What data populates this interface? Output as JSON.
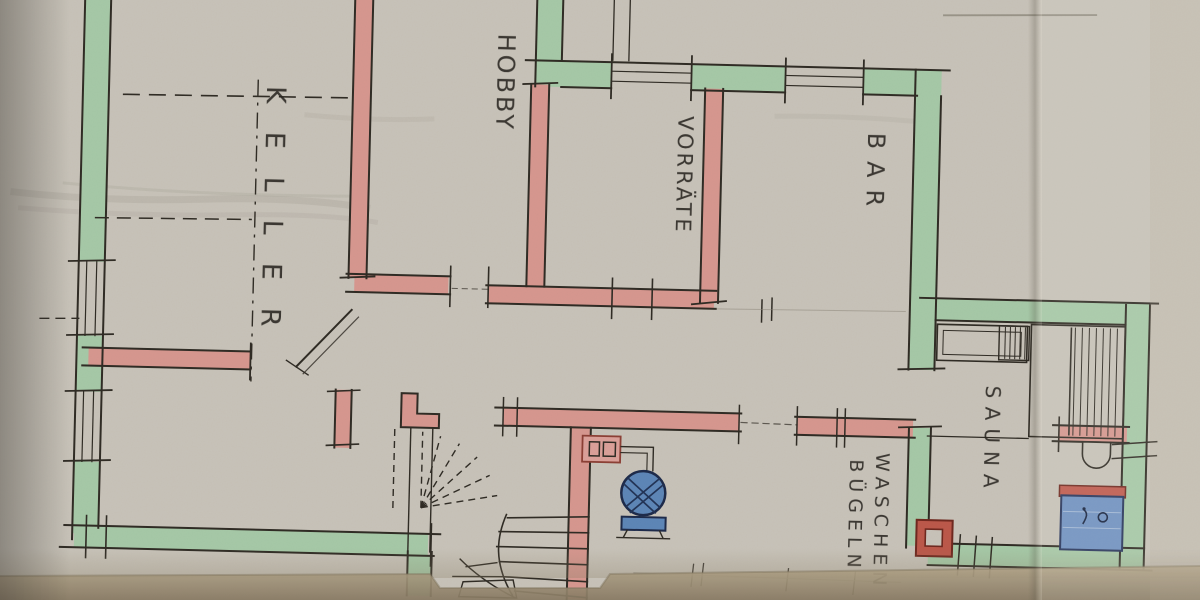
{
  "rooms": {
    "keller": {
      "label": "KELLER"
    },
    "hobby": {
      "label": "HOBBY"
    },
    "vorraete": {
      "label": "VORRÄTE"
    },
    "bar": {
      "label": "BAR"
    },
    "sauna": {
      "label": "SAUNA"
    },
    "waschen": {
      "label": "WASCHEN"
    },
    "buegeln": {
      "label": "BÜGELN"
    }
  },
  "symbols": {
    "boiler": "boiler-fan-symbol",
    "chimney": "chimney-flue-symbol",
    "shower": "shower-tray-symbol",
    "basin": "wash-basin-symbol",
    "stairs": "winder-stair-symbol"
  },
  "palette": {
    "paper": "#c8c3b9",
    "green": "#a6c9a7",
    "pink": "#d7978f",
    "blue": "#5d86b7",
    "blue2": "#7092c2",
    "red": "#bc584a",
    "ink": "#2f2b24",
    "pencil": "#8a8478",
    "tan": "#9d8f74"
  }
}
